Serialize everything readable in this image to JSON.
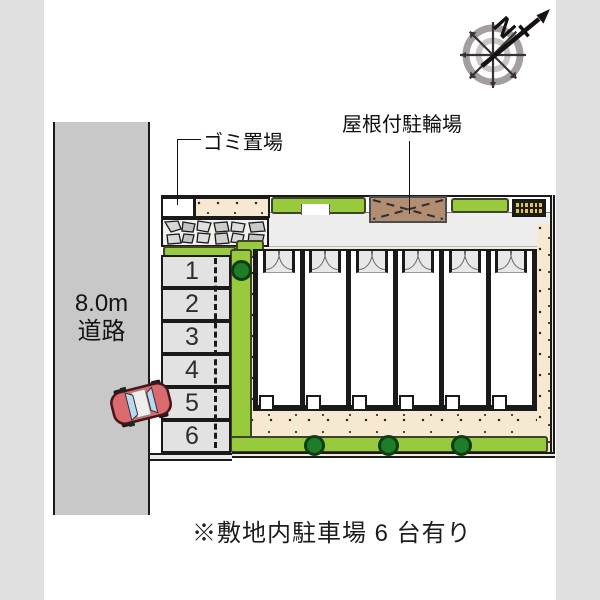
{
  "compass": {
    "north_label": "N"
  },
  "labels": {
    "garbage": "ゴミ置場",
    "bike_parking": "屋根付駐輪場",
    "road_width": "8.0m",
    "road_name": "道路",
    "note": "※敷地内駐車場 6 台有り"
  },
  "parking": {
    "stalls": [
      "1",
      "2",
      "3",
      "4",
      "5",
      "6"
    ]
  },
  "colors": {
    "page_margin": "#e0e0e0",
    "road": "#c8c8c8",
    "ground_beige": "#f7e9d1",
    "grass": "#97ca3c",
    "tree": "#1e7d26",
    "bike_shed": "#b18d72",
    "grate_yellow": "#dfc355",
    "car_red": "#db6a6e",
    "car_window": "#b9d9ef"
  }
}
